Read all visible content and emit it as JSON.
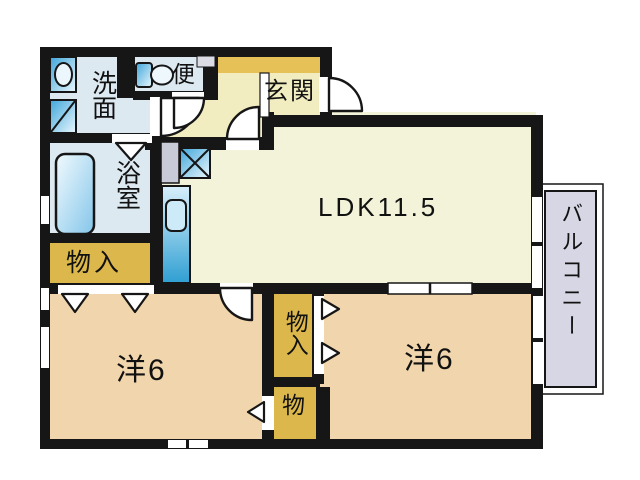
{
  "rooms": {
    "washroom": {
      "label": "洗面"
    },
    "toilet": {
      "label": "便"
    },
    "entrance": {
      "label": "玄関"
    },
    "bathroom": {
      "label": "浴室"
    },
    "storage_left": {
      "label": "物入"
    },
    "ldk": {
      "label": "LDK11.5"
    },
    "western_left": {
      "label": "洋6"
    },
    "storage_center": {
      "label": "物入"
    },
    "storage_small": {
      "label": "物"
    },
    "western_right": {
      "label": "洋6"
    },
    "balcony": {
      "label": "バルコニー"
    }
  },
  "colors": {
    "wall": "#161616",
    "wet_area_floor": "#dde9f0",
    "hall_floor": "#f1edc0",
    "ldk_floor": "#f3f3da",
    "room_floor": "#f1d5ac",
    "closet_fill": "#dcb84c",
    "genkan_band": "#e6c157",
    "balcony_fill": "#d6d6e4",
    "fixture_blue": "#5bb4e0"
  }
}
